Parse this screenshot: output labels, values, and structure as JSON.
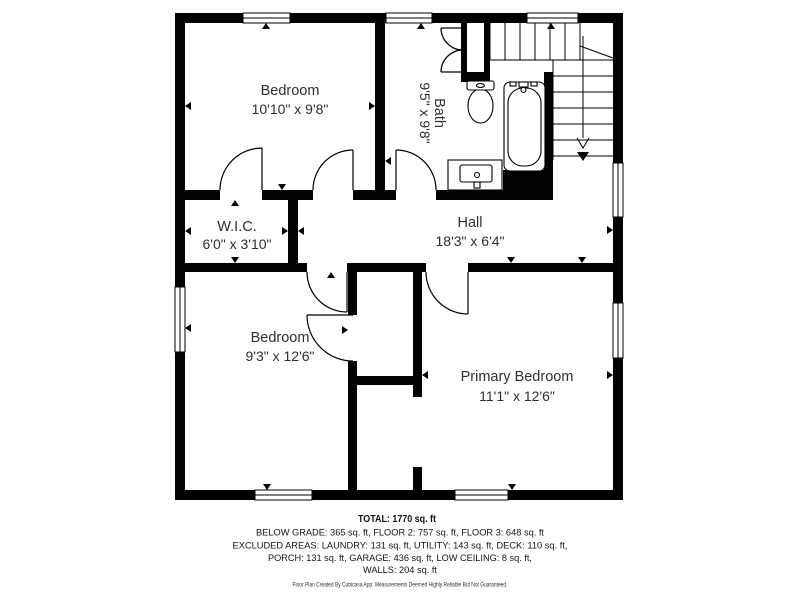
{
  "rooms": {
    "bedroom_top": {
      "name": "Bedroom",
      "dims": "10'10\" x 9'8\""
    },
    "bath": {
      "name": "Bath",
      "dims": "9'5\" x 9'8\""
    },
    "wic": {
      "name": "W.I.C.",
      "dims": "6'0\" x 3'10\""
    },
    "hall": {
      "name": "Hall",
      "dims": "18'3\" x 6'4\""
    },
    "bedroom_bottom": {
      "name": "Bedroom",
      "dims": "9'3\" x 12'6\""
    },
    "primary_bedroom": {
      "name": "Primary Bedroom",
      "dims": "11'1\" x 12'6\""
    }
  },
  "summary": {
    "total": "TOTAL: 1770 sq. ft",
    "line1": "BELOW GRADE: 365 sq. ft, FLOOR 2: 757 sq. ft, FLOOR 3: 648 sq. ft",
    "line2": "EXCLUDED AREAS: LAUNDRY: 131 sq. ft, UTILITY: 143 sq. ft, DECK: 110 sq. ft,",
    "line3": "PORCH: 131 sq. ft, GARAGE: 436 sq. ft, LOW CEILING: 8 sq. ft,",
    "line4": "WALLS: 204 sq. ft"
  },
  "disclaimer": "Floor Plan Created By Cubicasa App. Measurements Deemed Highly Reliable But Not Guaranteed.",
  "colors": {
    "walls": "#000000",
    "room_text": "#2f2f2f",
    "summary_text": "#141414",
    "background": "#ffffff"
  }
}
